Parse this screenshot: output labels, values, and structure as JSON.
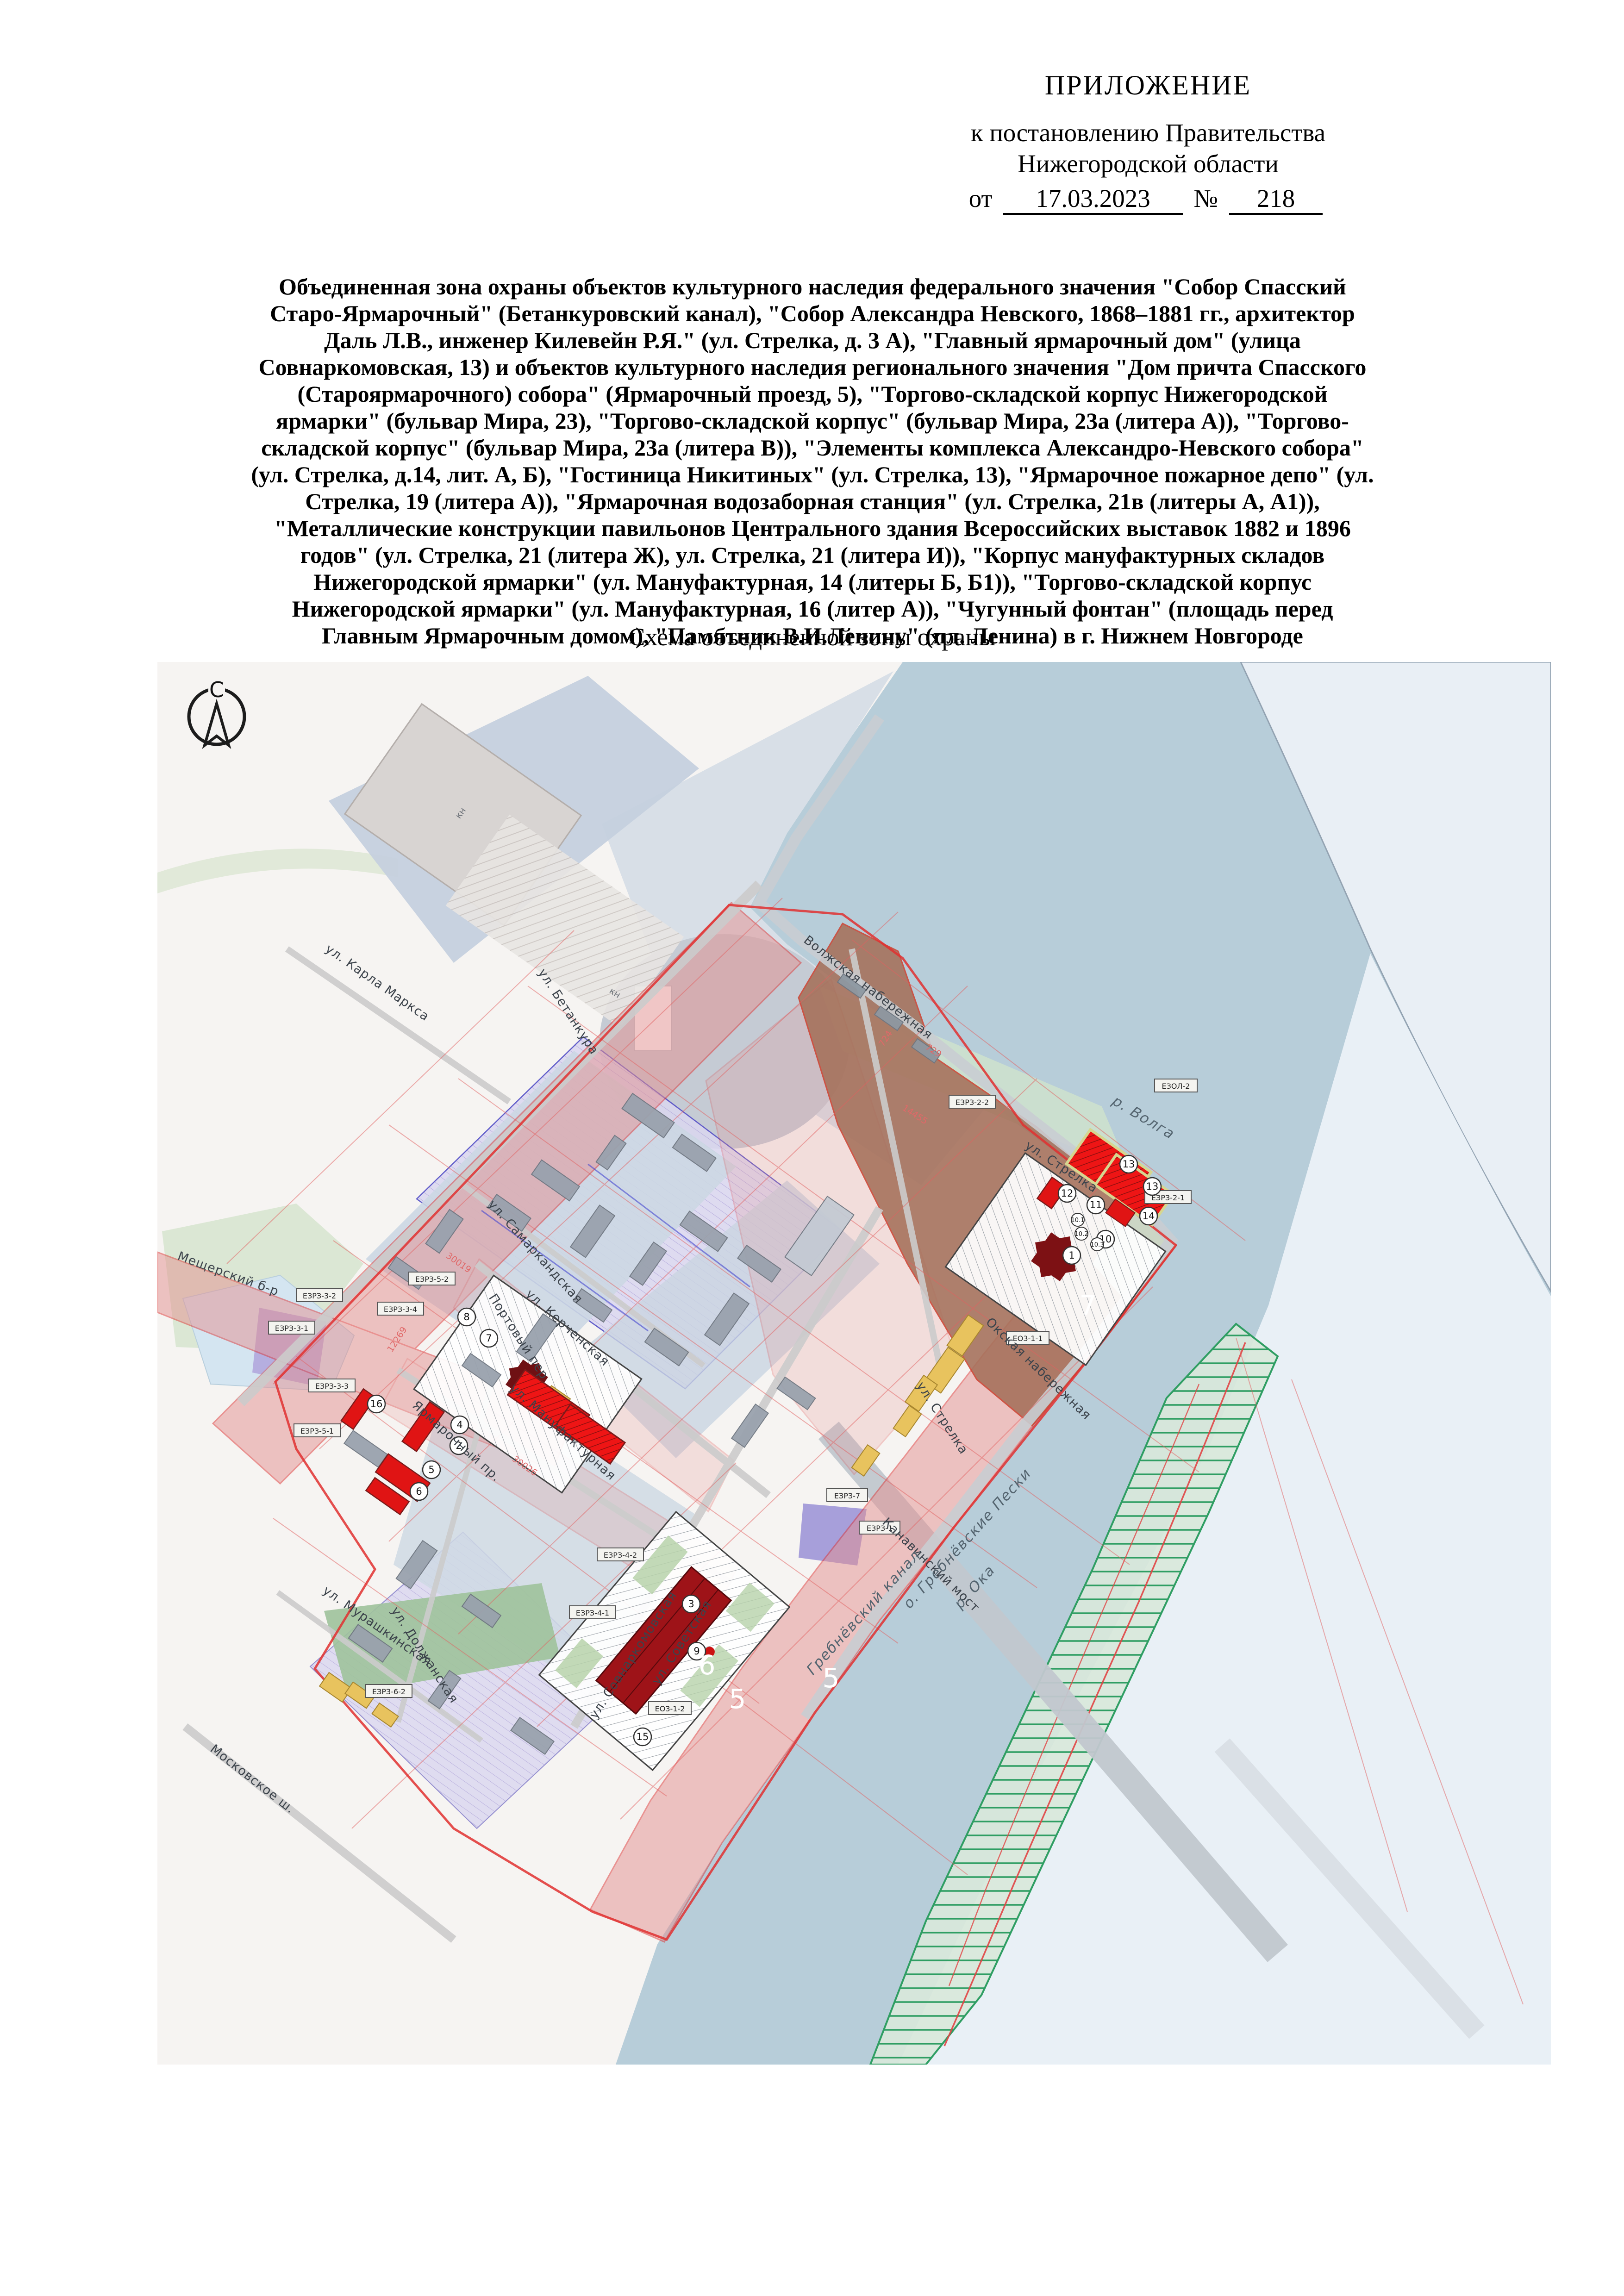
{
  "document": {
    "appendix_label": "ПРИЛОЖЕНИЕ",
    "to_resolution_line1": "к постановлению Правительства",
    "to_resolution_line2": "Нижегородской области",
    "date_prefix": "от",
    "date_value": "17.03.2023",
    "number_sign": "№",
    "number_value": "218",
    "title_paragraph": "Объединенная зона охраны объектов культурного наследия федерального значения \"Собор Спасский Старо-Ярмарочный\" (Бетанкуровский канал), \"Собор Александра Невского, 1868–1881 гг., архитектор Даль Л.В., инженер Килевейн Р.Я.\" (ул. Стрелка, д. 3 А), \"Главный ярмарочный дом\" (улица Совнаркомовская, 13) и объектов культурного наследия регионального значения \"Дом причта Спасского (Староярмарочного) собора\" (Ярмарочный проезд, 5), \"Торгово-складской корпус Нижегородской ярмарки\" (бульвар Мира, 23), \"Торгово-складской корпус\" (бульвар Мира, 23а (литера А)), \"Торгово-складской корпус\" (бульвар Мира, 23а (литера В)), \"Элементы комплекса Александро-Невского собора\" (ул. Стрелка, д.14, лит. А, Б), \"Гостиница Никитиных\" (ул. Стрелка, 13), \"Ярмарочное пожарное депо\" (ул. Стрелка, 19 (литера А)), \"Ярмарочная водозаборная станция\" (ул. Стрелка, 21в (литеры А, А1)), \"Металлические конструкции павильонов Центрального здания Всероссийских выставок 1882 и 1896 годов\" (ул. Стрелка, 21 (литера Ж), ул. Стрелка, 21 (литера И)), \"Корпус мануфактурных складов Нижегородской ярмарки\" (ул. Мануфактурная, 14 (литеры Б, Б1)), \"Торгово-складской корпус Нижегородской ярмарки\" (ул. Мануфактурная, 16 (литер А)), \"Чугунный фонтан\" (площадь перед Главным Ярмарочным домом), \"Памятник В.И.Ленину\" (пл. Ленина) в г. Нижнем Новгороде",
    "subtitle": "Схема объединенной зоны охраны"
  },
  "map": {
    "compass_letter": "С",
    "water_labels": {
      "volga": "р. Волга",
      "oka": "р. Ока",
      "kanal": "Гребнёвский канал",
      "peski": "о. Гребнёвские Пески"
    },
    "bridge_label": "Канавинский мост",
    "street_labels": {
      "karl_marksa": "ул. Карла Маркса",
      "betankura": "ул. Бетанкура",
      "volzhskaya": "Волжская набережная",
      "samarkandskaya": "ул. Самаркандская",
      "sovnarkomovskaya": "ул. Совнаркомовская",
      "manufakturnaya": "ул. Мануфактурная",
      "yarmarochny": "Ярмарочный пр.",
      "dolzhanskaya": "ул. Должанская",
      "portovy": "Портовый пер",
      "kerchenskaya": "ул. Керченская",
      "strelka": "ул. Стрелка",
      "sovetskaya": "ул. Советская",
      "okskaya": "Окская набережная",
      "meshchersky": "Мещерский б-р",
      "murashkinskaya": "ул. Мурашкинская",
      "moskovskoe": "Московское ш."
    },
    "zone_codes": {
      "ezol2": "ЕЗОЛ-2",
      "ezrz22": "ЕЗРЗ-2-2",
      "ezrz21": "ЕЗРЗ-2-1",
      "eo311": "ЕО3-1-1",
      "eo312": "ЕО3-1-2",
      "ezrz1": "ЕЗРЗ-1",
      "ezrz7": "ЕЗРЗ-7",
      "ezrz52": "ЕЗРЗ-5-2",
      "ezrz34": "ЕЗРЗ-3-4",
      "ezrz32": "ЕЗРЗ-3-2",
      "ezrz31": "ЕЗРЗ-3-1",
      "ezrz33": "ЕЗРЗ-3-3",
      "ezrz51": "ЕЗРЗ-5-1",
      "ezrz41": "ЕЗРЗ-4-1",
      "ezrz42": "ЕЗРЗ-4-2",
      "ezrz62": "ЕЗРЗ-6-2"
    },
    "area_numbers": {
      "n7": "7",
      "n6": "6",
      "n5a": "5",
      "n5b": "5"
    },
    "markers": [
      "1",
      "2",
      "3",
      "4",
      "5",
      "6",
      "7",
      "8",
      "9",
      "10",
      "10.1",
      "10.2",
      "10.3",
      "11",
      "12",
      "13",
      "13",
      "14",
      "15",
      "16"
    ],
    "cadastral_numbers": {
      "c729": "729",
      "c724": "724",
      "c14455": "14455",
      "c12269": "12269",
      "c30026": "30026",
      "c30019": "30019"
    },
    "building_label_kn": "кн",
    "colors": {
      "water": "#b7cdd9",
      "far_bank": "#e9eff5",
      "island_green": "#2f9e63",
      "zone7_brown": "#a5705a",
      "corridor_pink": "#e49090",
      "monument_red": "#ee1515",
      "cathedral_dark_red": "#7d1114",
      "protected_yellow": "#e8c35e",
      "lavender_zone": "#dbd7f0",
      "boundary_red": "#e03030"
    }
  }
}
